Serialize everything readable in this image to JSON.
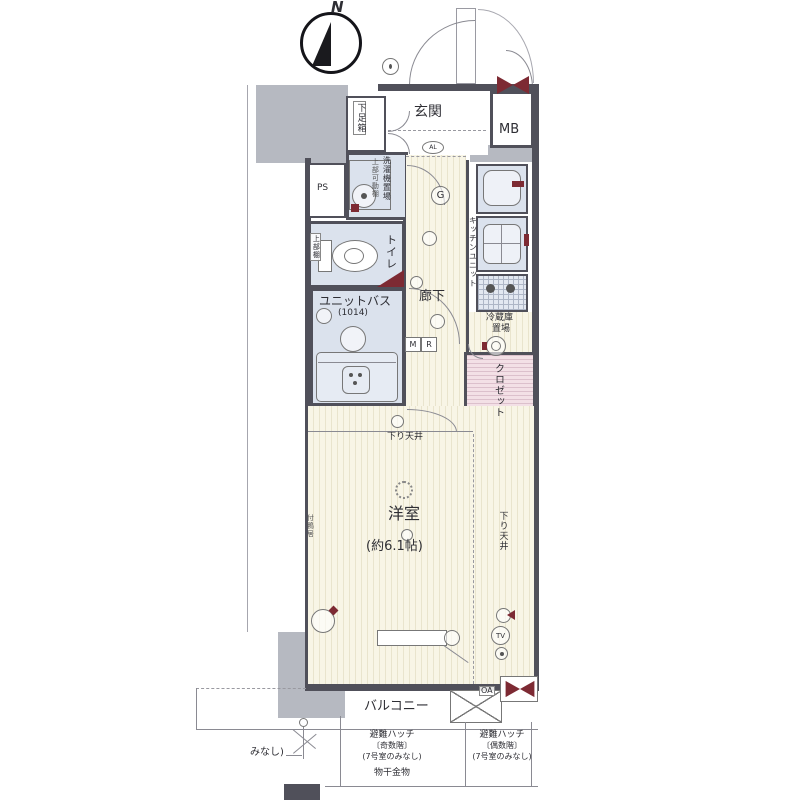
{
  "type": "floor_plan",
  "colors": {
    "wall": "#50505a",
    "neighbor_gray": "#b6b9c1",
    "wet_area_blue": "#dbe2ed",
    "flooring_cream": "#f8f5e6",
    "closet_pink": "#f3e0e6",
    "accent_dark_red": "#7d2a33"
  },
  "compass": {
    "label": "N"
  },
  "rooms": {
    "entrance": {
      "label": "玄関"
    },
    "meter_box": {
      "label": "MB"
    },
    "shoe_box": {
      "label": "下足箱"
    },
    "pipe_space": {
      "label": "PS"
    },
    "washer": {
      "label_main": "洗濯機置場",
      "label_sub": "上部可動棚"
    },
    "toilet": {
      "label": "トイレ",
      "shelf": "上部棚"
    },
    "unit_bath": {
      "label": "ユニットバス",
      "size": "(1014)"
    },
    "corridor": {
      "label": "廊下"
    },
    "kitchen": {
      "label": "キッチンユニット"
    },
    "fridge": {
      "line1": "冷蔵庫",
      "line2": "置場"
    },
    "closet": {
      "label": "クロゼット"
    },
    "main_room": {
      "label": "洋室",
      "size": "(約6.1帖)",
      "lowered_ceiling": "下り天井",
      "kamoi": "付鴨居"
    },
    "balcony": {
      "label": "バルコニー"
    }
  },
  "marks": {
    "g": "G",
    "al": "AL",
    "m": "M",
    "r": "R",
    "tv": "TV",
    "oa": "OA"
  },
  "annotations": {
    "hatch_left": {
      "line1": "避難ハッチ",
      "line2": "〔奇数階〕",
      "line3": "(7号室のみなし)"
    },
    "hatch_right": {
      "line1": "避難ハッチ",
      "line2": "〔偶数階〕",
      "line3": "(7号室のみなし)"
    },
    "laundry_hardware": "物干金物",
    "minashi_partial": "みなし)"
  }
}
